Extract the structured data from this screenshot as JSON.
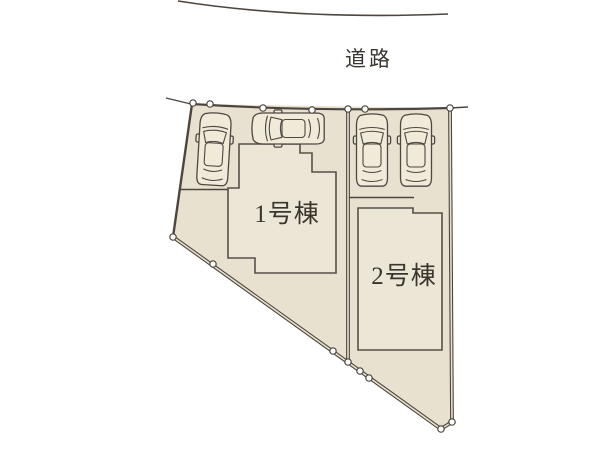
{
  "site_plan": {
    "road_label": "道路",
    "buildings": [
      {
        "id": 1,
        "label": "1号棟"
      },
      {
        "id": 2,
        "label": "2号棟"
      }
    ],
    "lots": 2,
    "cars_parked": 4,
    "boundary_markers": 15,
    "colors": {
      "background": "#ffffff",
      "lot_fill": "#e8e1cf",
      "building_fill": "#ece6d6",
      "boundary_line": "#4c463e",
      "marker_fill": "#ffffff",
      "text": "#3a352e"
    }
  }
}
